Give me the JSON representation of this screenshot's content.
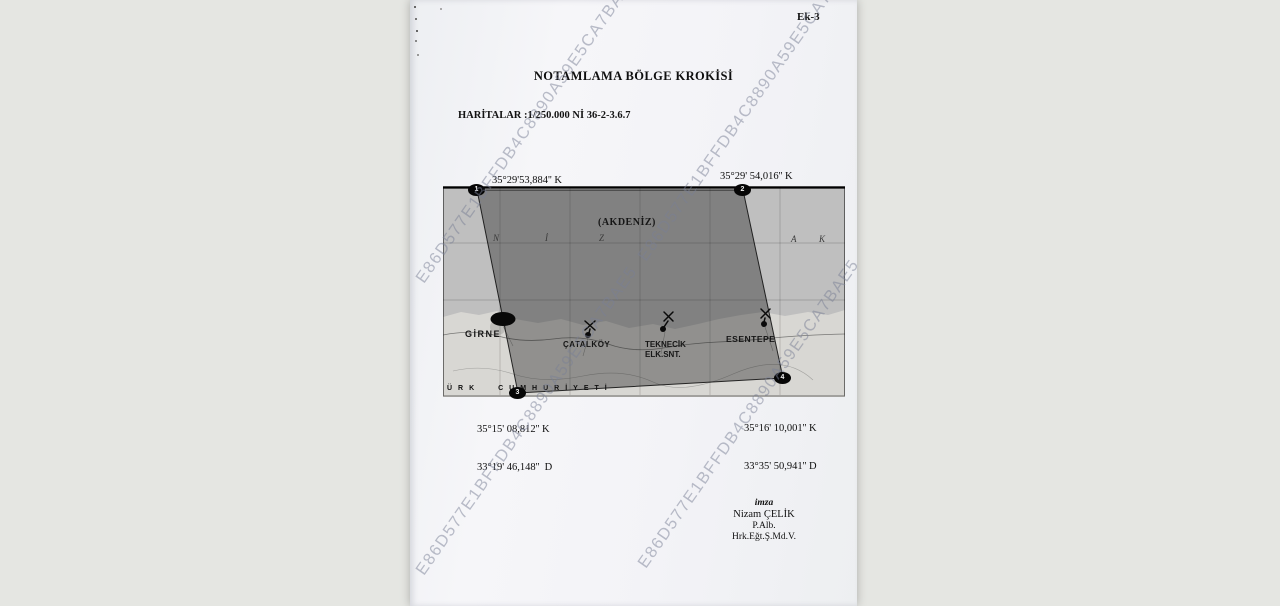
{
  "page": {
    "ek_label": "Ek-3",
    "title": "NOTAMLAMA BÖLGE KROKİSİ",
    "maps_reference": "HARİTALAR :1/250.000 Nİ 36-2-3.6.7",
    "watermark_text": "E86D577E1BFFDB4C8890A59E5CA7BAE5"
  },
  "coordinates": {
    "top_left": {
      "lat": "35°29'53,884'' K",
      "lon": "33°15'21,805''  D"
    },
    "top_right": {
      "lat": "35°29' 54,016'' K",
      "lon": "33°34' 0,691''  D"
    },
    "bottom_left": {
      "lat": "35°15' 08,812'' K",
      "lon": "33°19' 46,148''  D"
    },
    "bottom_right": {
      "lat": "35°16' 10,001'' K",
      "lon": "33°35' 50,941'' D"
    }
  },
  "map": {
    "sea_label": "(AKDENİZ)",
    "sea_letters": [
      "N",
      "İ",
      "Z",
      "A",
      "K"
    ],
    "corner_markers": [
      "1",
      "2",
      "3",
      "4"
    ],
    "towns": {
      "girne": "GİRNE",
      "catalkoy": "ÇATALKÖY",
      "teknecik_line1": "TEKNECİK",
      "teknecik_line2": "ELK.SNT.",
      "esentepe": "ESENTEPE"
    },
    "bottom_lettering": "ÜRK CUMHURİYETİ"
  },
  "signature": {
    "label": "imza",
    "name": "Nizam ÇELİK",
    "rank": "P.Alb.",
    "title": "Hrk.Eğt.Ş.Md.V."
  },
  "colors": {
    "backdrop": "#e5e6e2",
    "paper": "#f4f4f7",
    "sea": "#bfbfbf",
    "land": "#d8d7d3",
    "notam_overlay": "rgba(30,30,30,0.38)",
    "watermark": "#7a8096"
  }
}
